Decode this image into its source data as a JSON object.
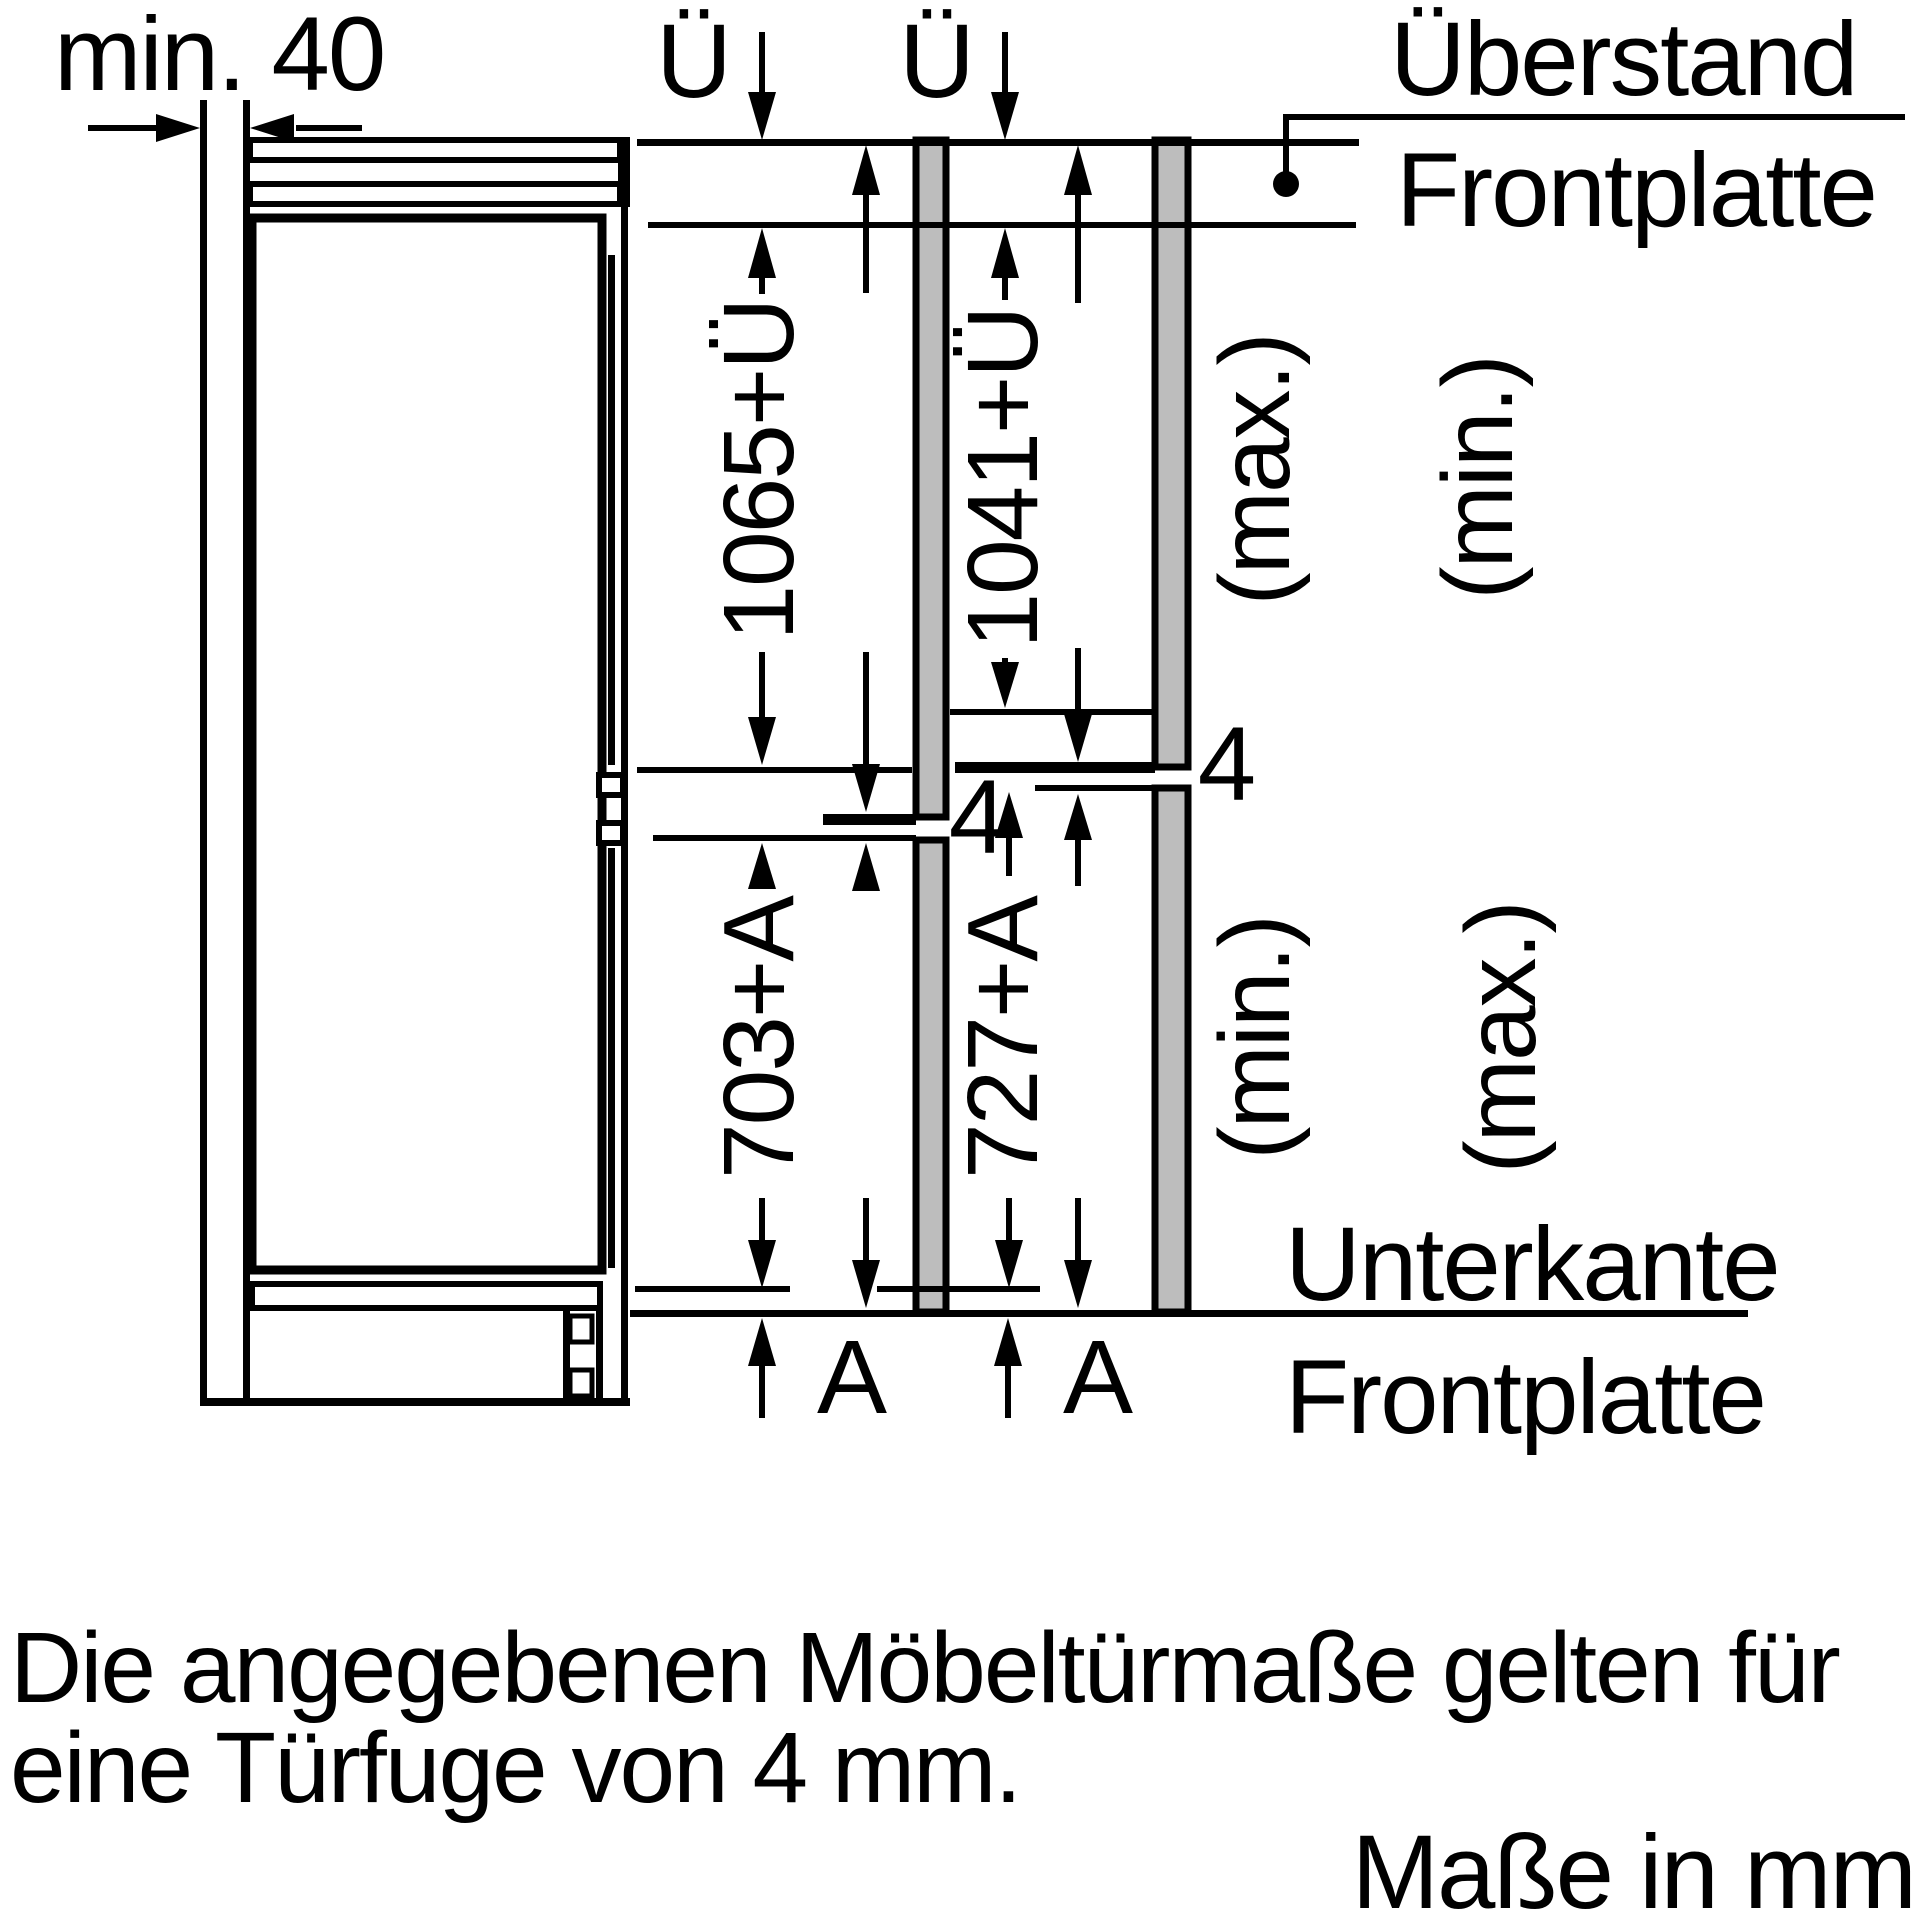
{
  "drawing": {
    "niche_gap_label": "min. 40",
    "overhang": {
      "symbol_left": "Ü",
      "symbol_right": "Ü",
      "callout_line1": "Überstand",
      "callout_line2": "Frontplatte"
    },
    "columns": {
      "upper_left": {
        "value": "1065+Ü",
        "qualifier": "(max.)"
      },
      "upper_right": {
        "value": "1041+Ü",
        "qualifier": "(min.)"
      },
      "lower_left": {
        "value": "703+A",
        "qualifier": "(min.)"
      },
      "lower_right": {
        "value": "727+A",
        "qualifier": "(max.)"
      }
    },
    "door_gap": {
      "left": "4",
      "right": "4"
    },
    "bottom_edge": {
      "line1": "Unterkante",
      "line2": "Frontplatte",
      "below_symbol_left": "A",
      "below_symbol_right": "A"
    }
  },
  "notes": {
    "door_gap_note_line1": "Die angegebenen Möbeltürmaße gelten für",
    "door_gap_note_line2": "eine Türfuge von 4 mm.",
    "units_note": "Maße in mm"
  },
  "colors": {
    "line_black": "#000000",
    "panel_gray": "#bdbdbd",
    "grille_gray": "#c6c6c6",
    "background": "#ffffff"
  }
}
